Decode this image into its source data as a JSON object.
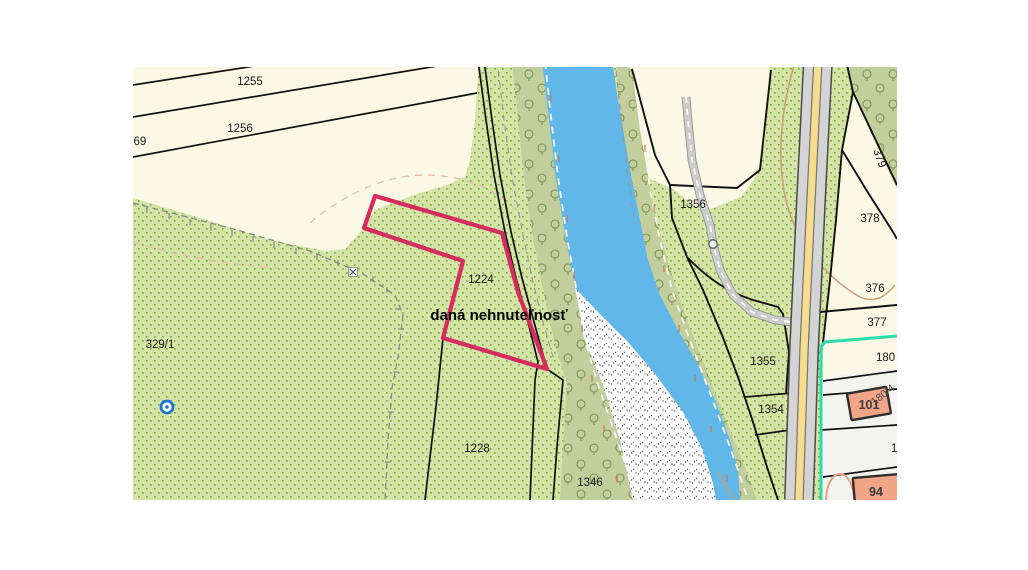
{
  "map_view": {
    "highlight": {
      "label": "daná nehnuteľnosť"
    },
    "parcels": {
      "p1255": "1255",
      "p1256": "1256",
      "p69": "69",
      "p329_1": "329/1",
      "p1224": "1224",
      "p1228": "1228",
      "p1346": "1346",
      "p1356": "1356",
      "p1355": "1355",
      "p1354": "1354",
      "p376": "376",
      "p377": "377",
      "p378": "378",
      "p379": "379",
      "p180": "180",
      "p180_4": "180/4",
      "p_cut_right": "1"
    },
    "buildings": {
      "b101": "101",
      "b94": "94"
    },
    "colors": {
      "highlight_outline": "#d52b5e",
      "water": "#61b7e8",
      "field": "#fbf8e6",
      "grass": "#d3e4a6",
      "grass_dot": "#84ab48",
      "riparian_band": "#c2ce9c",
      "tree_symbol": "#7c9456",
      "road_fill": "#d4d4d4",
      "road_stripe": "#f7dc8d",
      "boundary_teal": "#2bdca8",
      "building_fill": "#f2a486",
      "built_up_area": "#f3f3ef"
    },
    "symbols": {
      "well": "well-symbol",
      "waypoint": "track-waypoint-symbol",
      "survey_cross": "survey-cross-mark"
    }
  }
}
